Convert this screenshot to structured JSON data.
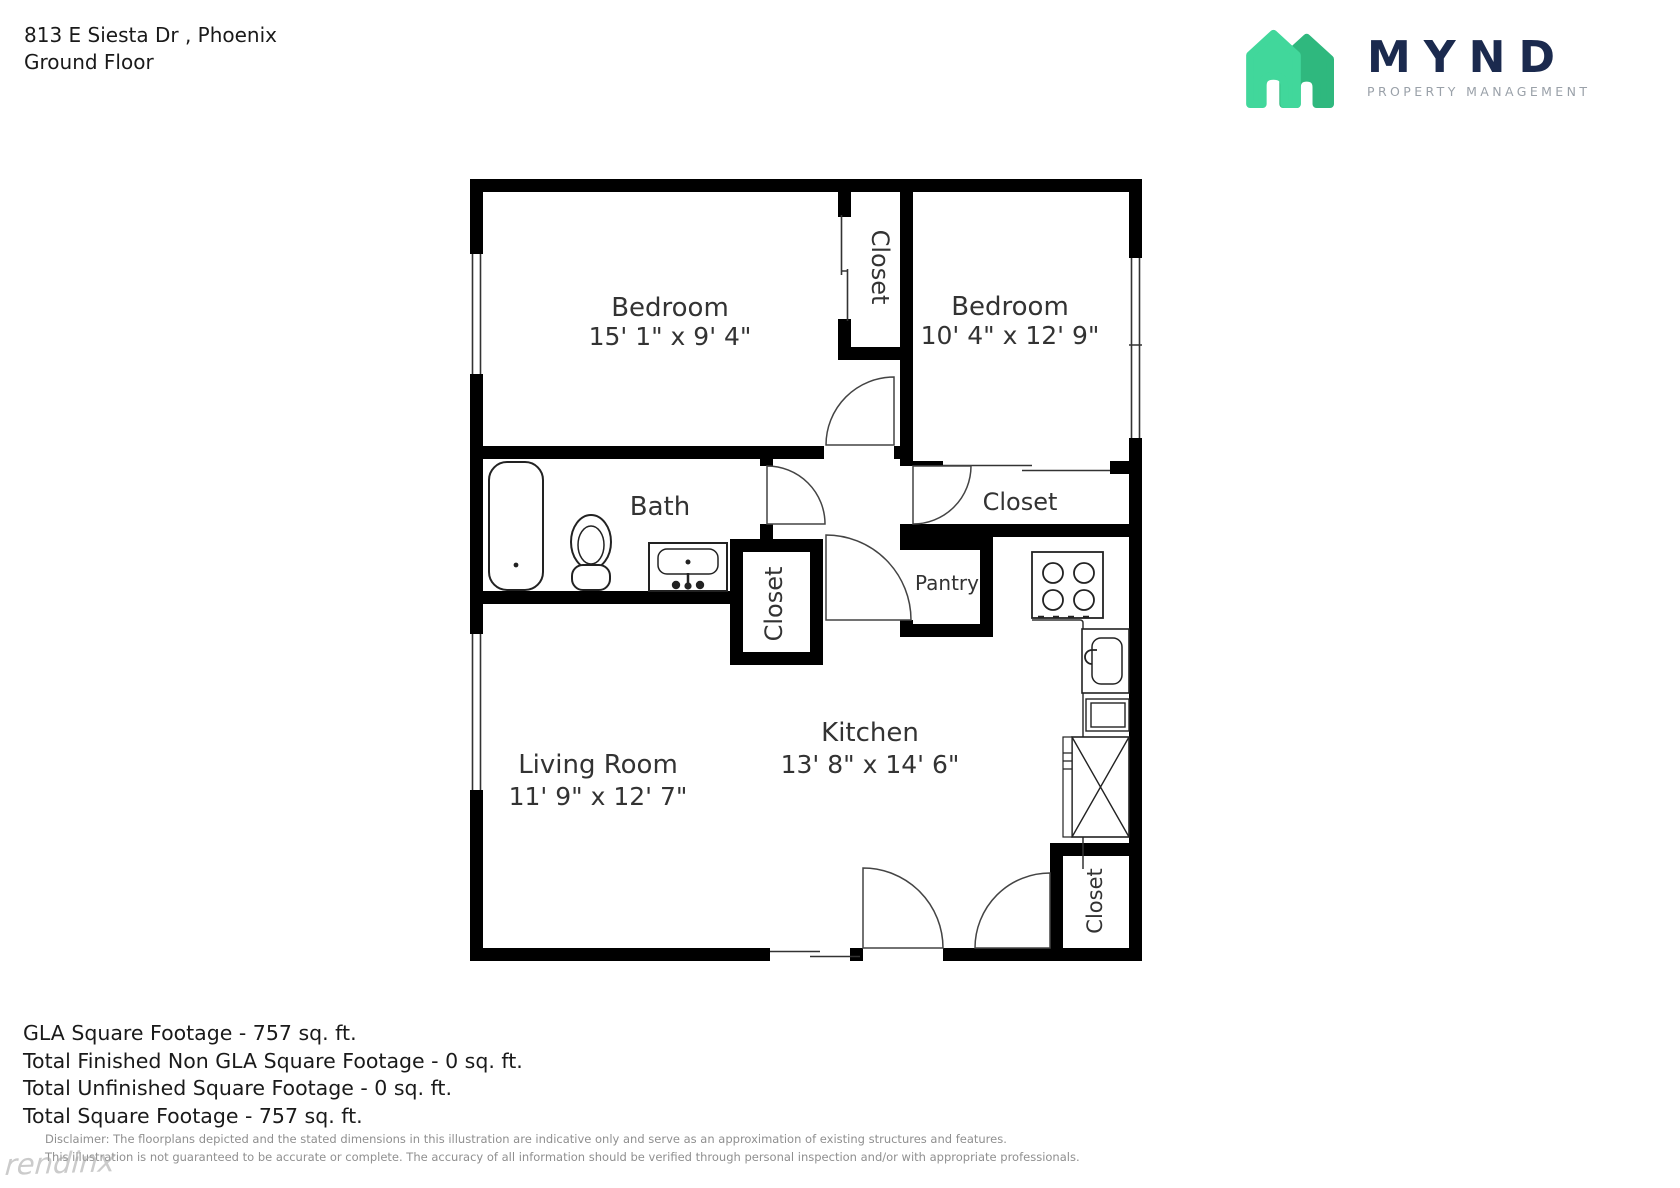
{
  "header": {
    "address": "813 E Siesta Dr , Phoenix",
    "floor": "Ground Floor"
  },
  "logo": {
    "wordmark": "MYND",
    "tagline": "PROPERTY MANAGEMENT",
    "colors": {
      "house_light": "#41d79b",
      "house_dark": "#2fb87e",
      "navy": "#1b2a4e",
      "gray": "#9aa1a9"
    }
  },
  "floorplan": {
    "rooms": {
      "bedroom1": {
        "name": "Bedroom",
        "dims": "15' 1\" x 9' 4\""
      },
      "bedroom2": {
        "name": "Bedroom",
        "dims": "10' 4\" x 12' 9\""
      },
      "bath": {
        "name": "Bath"
      },
      "closet_bedrooms": {
        "name": "Closet"
      },
      "closet_hall": {
        "name": "Closet"
      },
      "closet_bedroom2": {
        "name": "Closet"
      },
      "closet_entry": {
        "name": "Closet"
      },
      "pantry": {
        "name": "Pantry"
      },
      "kitchen": {
        "name": "Kitchen",
        "dims": "13' 8\" x 14' 6\""
      },
      "living": {
        "name": "Living Room",
        "dims": "11' 9\" x 12' 7\""
      }
    },
    "fixtures": [
      "bathtub",
      "toilet",
      "vanity-sink",
      "stove",
      "kitchen-sink",
      "cabinet",
      "crossed-box-appliance"
    ],
    "wall_color": "#000000"
  },
  "footer": {
    "totals": {
      "gla": "GLA Square Footage - 757 sq. ft.",
      "non_gla": "Total Finished Non GLA Square Footage - 0 sq. ft.",
      "unfinished": "Total Unfinished Square Footage - 0 sq. ft.",
      "total": "Total Square Footage - 757 sq. ft."
    },
    "disclaimer": {
      "line1": "Disclaimer: The floorplans depicted and the stated dimensions in this illustration are indicative only and serve as an approximation of existing structures and features.",
      "line2": "This illustration is not guaranteed to be accurate or complete. The accuracy of all information should be verified through personal inspection and/or with appropriate professionals."
    },
    "watermark": "rendinx"
  }
}
